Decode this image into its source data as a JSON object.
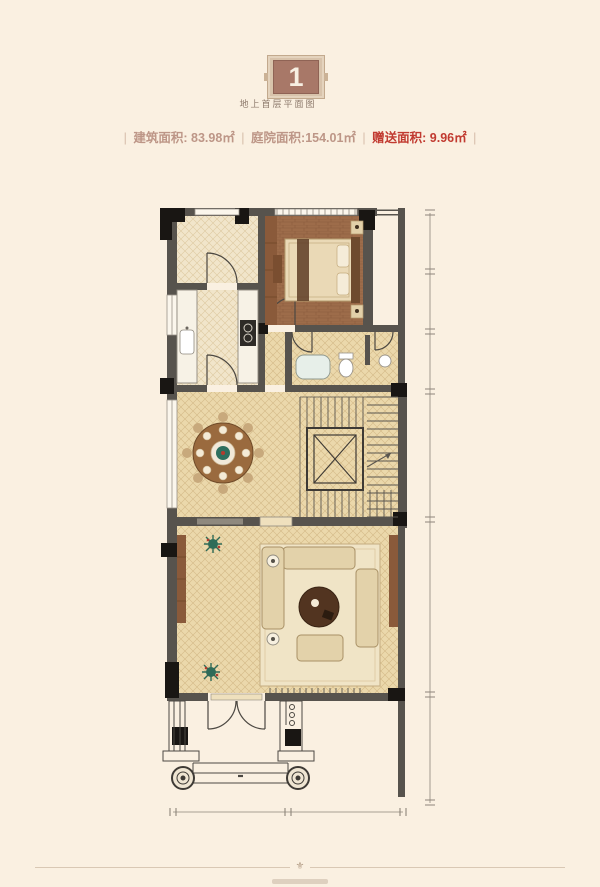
{
  "page": {
    "background": "#faf0e1"
  },
  "header": {
    "floor_badge": "1",
    "floor_title": "地上首层平面图",
    "separator": "|",
    "stats": [
      {
        "label": "建筑面积:",
        "value": "83.98㎡"
      },
      {
        "label": "庭院面积:",
        "value": "154.01㎡"
      },
      {
        "label": "赠送面积:",
        "value": "9.96㎡",
        "highlight": true
      }
    ],
    "colors": {
      "badge_bg": "#a87868",
      "badge_frame": "#d8c3ab",
      "stat_text": "#bd9687",
      "stat_highlight": "#c13a30"
    }
  },
  "plan": {
    "type": "floor-plan",
    "floor_number": "1",
    "rooms": [
      "entry-hall",
      "bedroom",
      "kitchen",
      "hallway",
      "bathroom",
      "dining",
      "elevator",
      "stairs",
      "living-room",
      "entry-porch"
    ],
    "colors": {
      "wall": "#57534d",
      "column": "#191613",
      "floor_light": "#f1e5ca",
      "floor_tan": "#ebd8ab",
      "hatch": "#d5bd90",
      "wood": "#9d6c4a",
      "rug": "#f0e4c6",
      "sofa": "#e3d2aa",
      "dimension": "#8d857a"
    }
  },
  "footer": {
    "ornament": "⚜"
  }
}
